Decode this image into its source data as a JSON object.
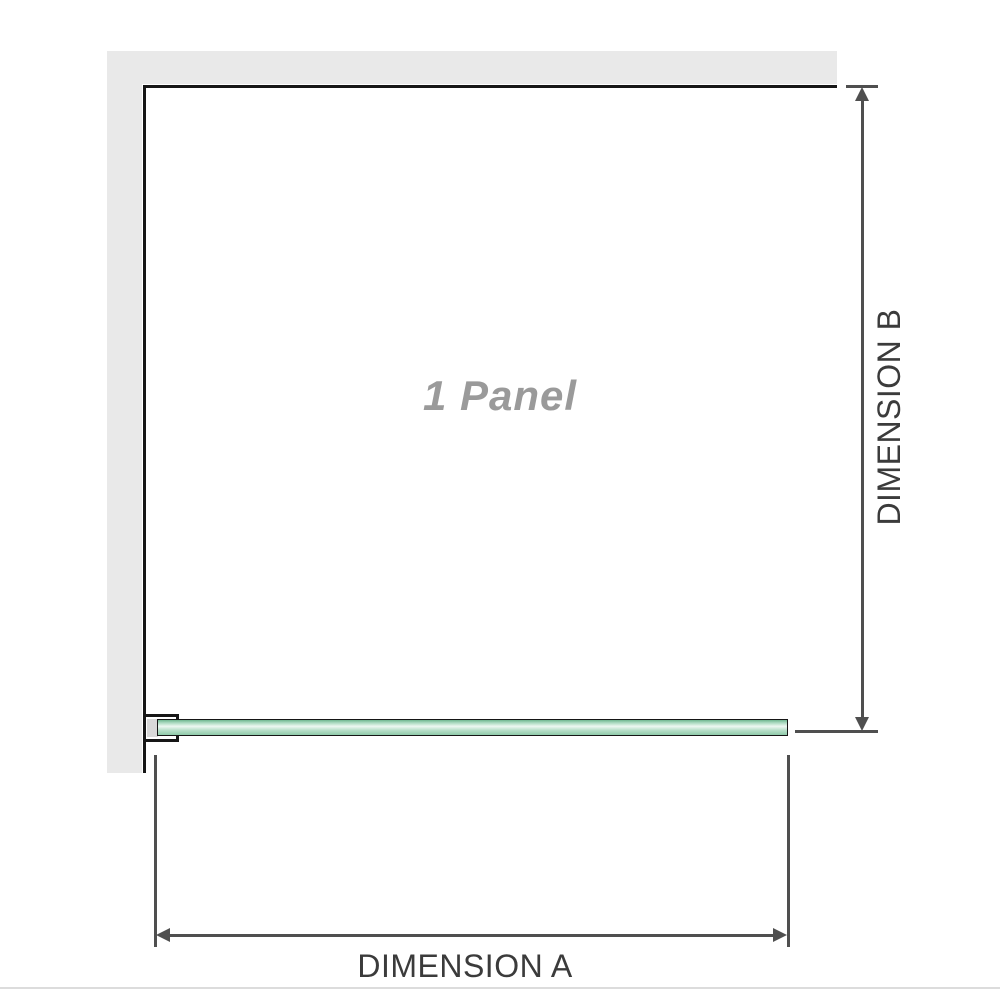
{
  "diagram": {
    "panel_label": "1 Panel",
    "dimension_a": {
      "label": "DIMENSION A"
    },
    "dimension_b": {
      "label": "DIMENSION B"
    }
  },
  "colors": {
    "wall_gray": "#e9e9e9",
    "outline_black": "#161616",
    "dimension_gray": "#4f4f4f",
    "label_gray": "#3b3b3b",
    "panel_text_gray": "#9a9a9a",
    "glass_green_dark": "#6fb690",
    "glass_green_mid": "#a9d9bf",
    "glass_green_light": "#eef8f2",
    "glass_green_mid2": "#b9e0ca",
    "glass_green_dark2": "#8fcaa9",
    "bracket_fill": "#d8d8d8",
    "divider_gray": "#dcdcdc"
  }
}
